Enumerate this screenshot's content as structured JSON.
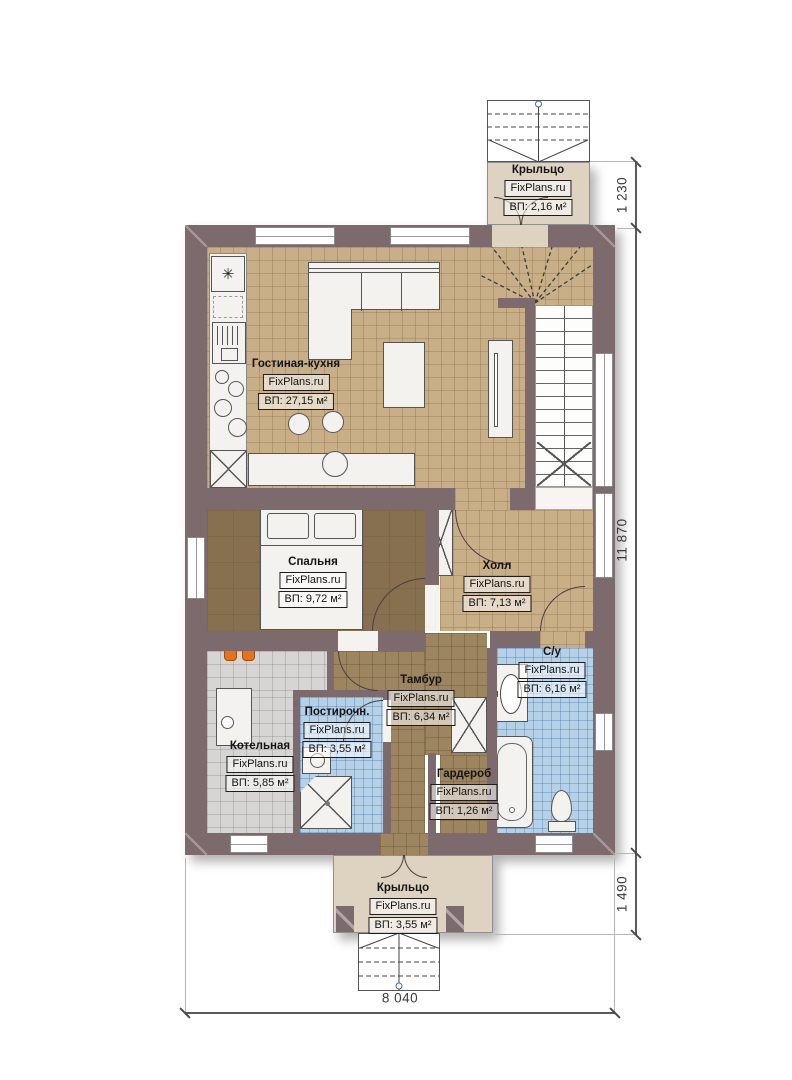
{
  "plan": {
    "rooms": [
      {
        "id": "porch-top",
        "name": "Крыльцо",
        "brand": "FixPlans.ru",
        "area": "ВП: 2,16 м²"
      },
      {
        "id": "living-kitchen",
        "name": "Гостиная-кухня",
        "brand": "FixPlans.ru",
        "area": "ВП: 27,15 м²"
      },
      {
        "id": "bedroom",
        "name": "Спальня",
        "brand": "FixPlans.ru",
        "area": "ВП: 9,72 м²"
      },
      {
        "id": "hall",
        "name": "Холл",
        "brand": "FixPlans.ru",
        "area": "ВП: 7,13 м²"
      },
      {
        "id": "bathroom",
        "name": "С/у",
        "brand": "FixPlans.ru",
        "area": "ВП: 6,16 м²"
      },
      {
        "id": "vestibule",
        "name": "Тамбур",
        "brand": "FixPlans.ru",
        "area": "ВП: 6,34 м²"
      },
      {
        "id": "laundry",
        "name": "Постирочн.",
        "brand": "FixPlans.ru",
        "area": "ВП: 3,55 м²"
      },
      {
        "id": "boiler",
        "name": "Котельная",
        "brand": "FixPlans.ru",
        "area": "ВП: 5,85 м²"
      },
      {
        "id": "wardrobe",
        "name": "Гардероб",
        "brand": "FixPlans.ru",
        "area": "ВП: 1,26 м²"
      },
      {
        "id": "porch-bottom",
        "name": "Крыльцо",
        "brand": "FixPlans.ru",
        "area": "ВП: 3,55 м²"
      }
    ],
    "dimensions": {
      "top_right": "1 230",
      "right_side": "11 870",
      "bottom_right": "1 490",
      "bottom": "8 040"
    },
    "icons": {
      "fridge_snowflake": "✳"
    }
  },
  "colors": {
    "wall": "#7d6a6c",
    "floor_tan": "#c8af88",
    "floor_bedroom": "#877050",
    "floor_vestibule": "#9c855f",
    "floor_wet": "#b4d1e8",
    "floor_boiler": "#d6d5d3",
    "porch": "#ded3c0",
    "radiator": "#e8711f"
  }
}
